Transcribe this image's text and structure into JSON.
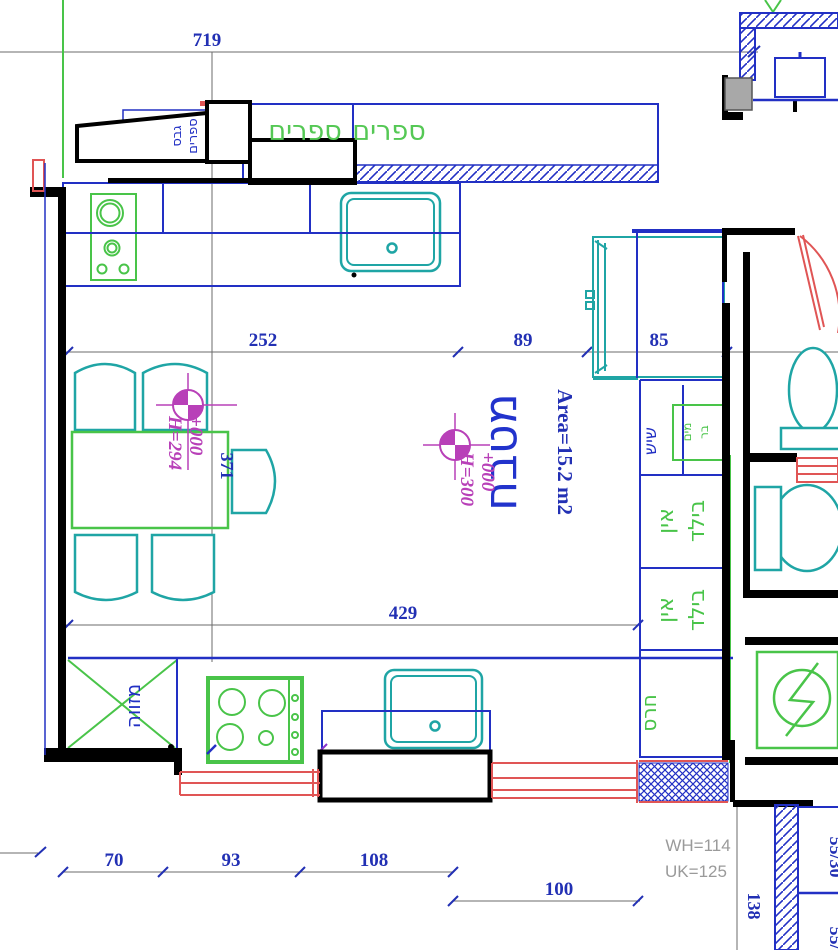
{
  "title": "kitchen-floor-plan",
  "colors": {
    "line_blue": "#2230c4",
    "dim_text_blue": "#2230b4",
    "green": "#49c449",
    "teal": "#1fa5a5",
    "magenta": "#b840b8",
    "red": "#e05555",
    "gray_line": "#6b6b6b",
    "gray_text": "#9a9a9a",
    "black": "#000000"
  },
  "labels": {
    "room": "מטבח",
    "area": "Area=15.2 m2",
    "bookshelf_word_1": "ספרים",
    "bookshelf_word_2": "ספרים",
    "soffit_col_1": "ספרים",
    "soffit_col_2": "גבס",
    "pantry": "מזווה",
    "countertop": "שיש",
    "bar_col_1": "בר",
    "bar_col_2": "מים",
    "builtin_top_col_1": "בילד",
    "builtin_top_col_2": "אין",
    "builtin_bottom_col_1": "בילד",
    "builtin_bottom_col_2": "אין",
    "ceramic": "חרס"
  },
  "levels": {
    "kitchen_level": "+000",
    "kitchen_height": "H=300",
    "dining_level": "+000",
    "dining_height": "H=294"
  },
  "dimensions": {
    "top": "719",
    "counter_run": "252",
    "passage": "89",
    "cabinet": "85",
    "table_depth": "371",
    "lower_run": "429",
    "win_seg1": "70",
    "win_seg2": "93",
    "win_seg3": "108",
    "win_seg4": "100",
    "right_wall": "138"
  },
  "annotations": {
    "window_head": "WH=114",
    "window_sill": "UK=125",
    "tile_1": "55/30",
    "tile_2": "55/30"
  }
}
